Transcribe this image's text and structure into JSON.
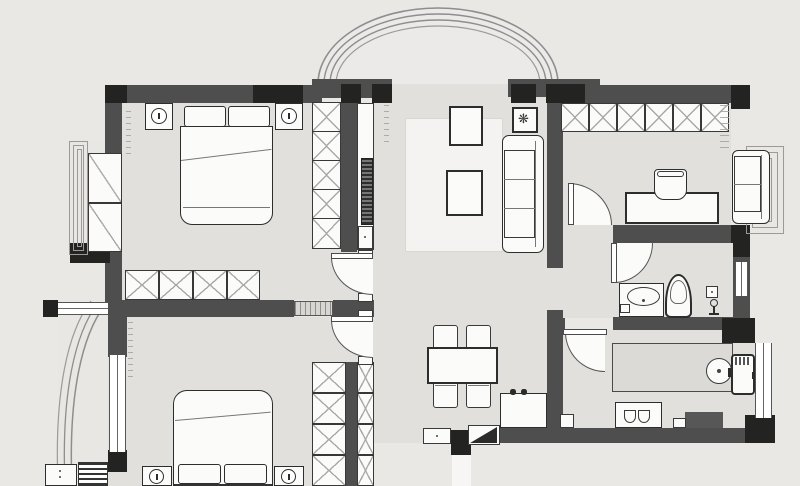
{
  "document": {
    "type": "apartment-floor-plan",
    "description": "Top-down architectural floor plan drawing of a two-bedroom apartment with living room, study, dining area, kitchen, bathroom and two balconies"
  },
  "colors": {
    "canvas": "#e9e8e5",
    "floor": "#e1e0dd",
    "floor_light": "#e8e7e4",
    "wall": "#4e4e4e",
    "col": "#232322",
    "line": "#2d2d2d",
    "fill": "#fbfbfa",
    "counter": "#dbdad7",
    "counter_dark": "#575757",
    "arc": "#8e8e8e",
    "rug": "#f4f3f1"
  },
  "icons": {
    "plant": "❋"
  },
  "rooms": [
    {
      "id": "bedroom-1",
      "furniture": [
        "double-bed",
        "nightstand-with-lamp-left",
        "nightstand-with-lamp-right",
        "wardrobe-column",
        "wardrobe-row",
        "bay-window-cabinet",
        "bay-window"
      ]
    },
    {
      "id": "living-room",
      "furniture": [
        "sofa",
        "coffee-table",
        "console-table",
        "side-table-with-plant",
        "wall-tv",
        "rug",
        "curved-balcony-arc"
      ]
    },
    {
      "id": "study",
      "furniture": [
        "wardrobe-row",
        "desk",
        "desk-chair",
        "loveseat",
        "bay-window",
        "door-swing"
      ]
    },
    {
      "id": "bathroom",
      "furniture": [
        "vanity-sink",
        "toilet",
        "shower-fixture",
        "window",
        "door-swing"
      ]
    },
    {
      "id": "kitchen",
      "furniture": [
        "counter",
        "round-sink",
        "refrigerator",
        "cooktop",
        "dark-counter",
        "window",
        "door-swing"
      ]
    },
    {
      "id": "dining",
      "furniture": [
        "dining-table",
        "dining-chairs-x4",
        "utility-sink-counter"
      ]
    },
    {
      "id": "bedroom-2",
      "furniture": [
        "double-bed",
        "nightstand-with-lamp-left",
        "nightstand-with-lamp-right",
        "wardrobe-column",
        "hall-cabinet-column",
        "radiator",
        "shoe-cabinet",
        "window",
        "curved-balcony",
        "door-swing"
      ]
    },
    {
      "id": "entry",
      "furniture": [
        "entry-door-triangle",
        "door-mat",
        "entry-path"
      ]
    }
  ]
}
